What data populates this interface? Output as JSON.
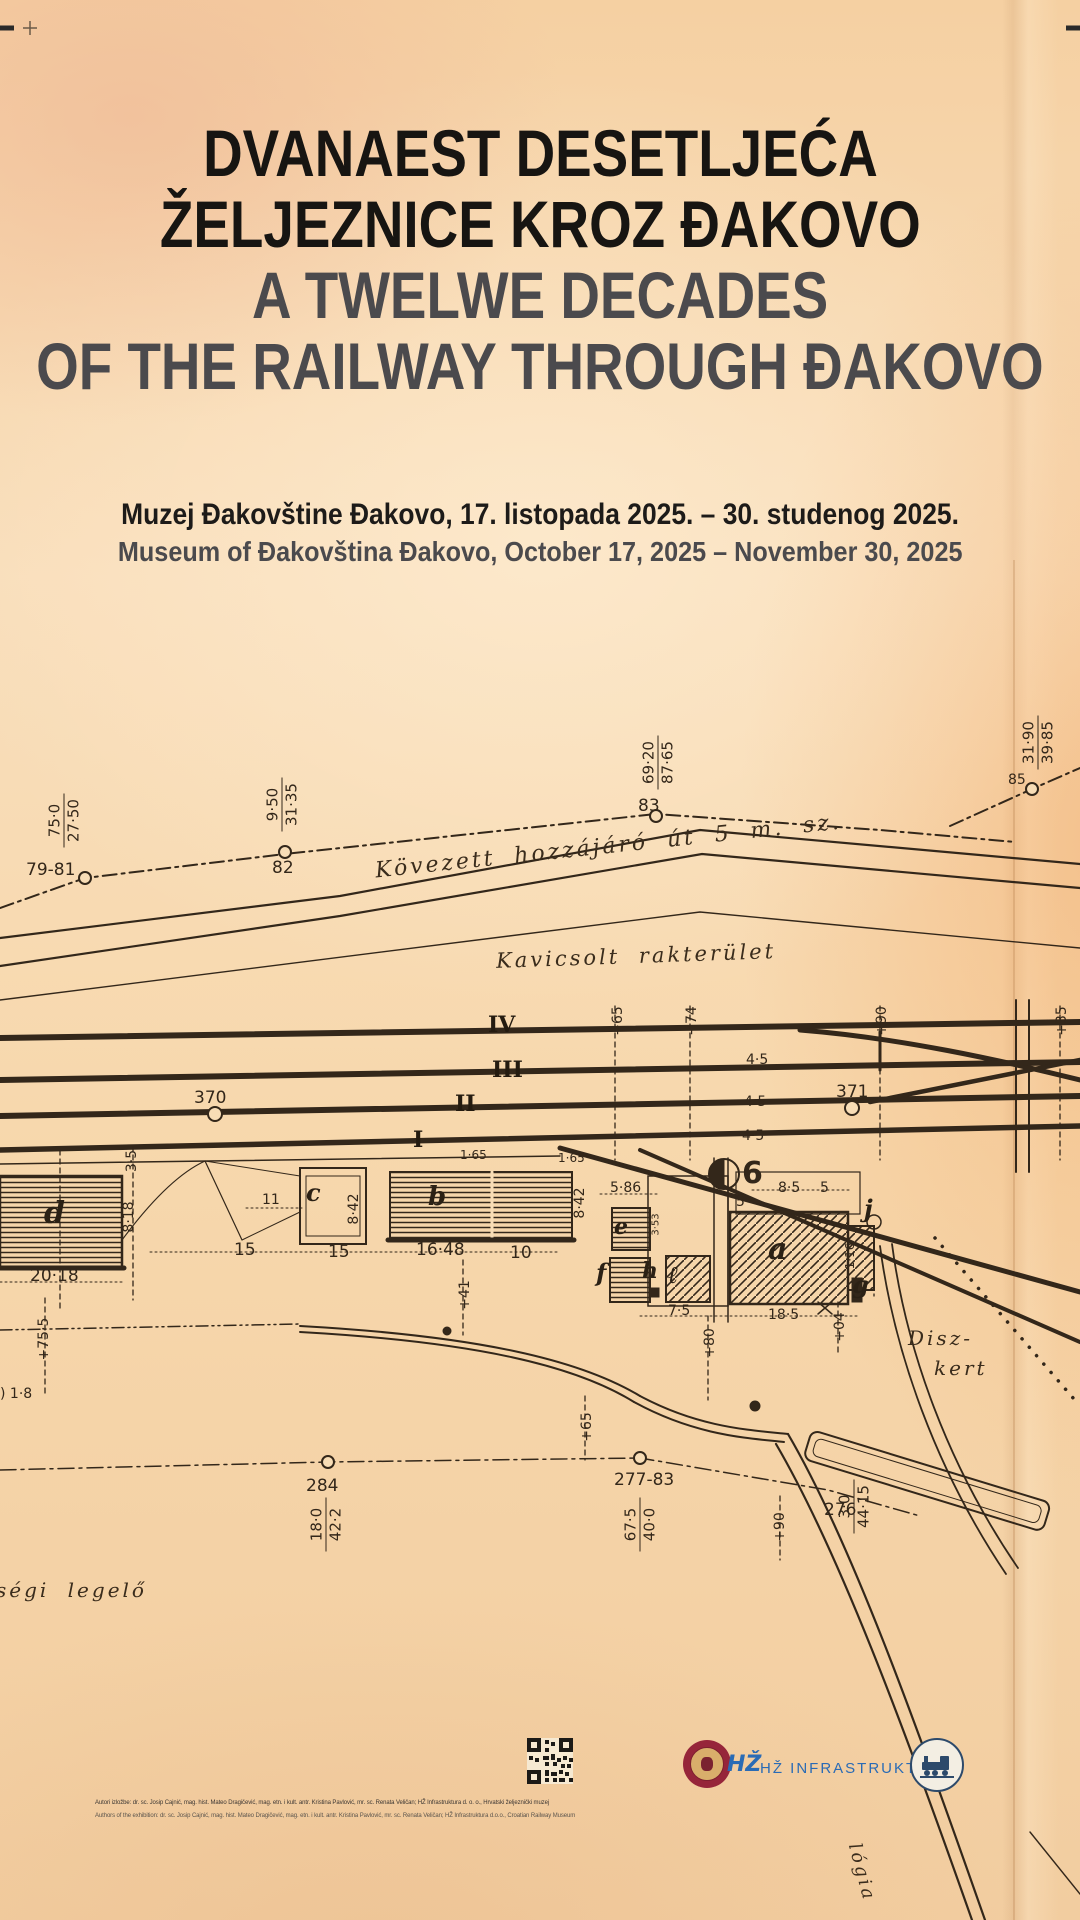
{
  "header": {
    "title_hr_1": "DVANAEST DESETLJEĆA",
    "title_hr_2": "ŽELJEZNICE KROZ ĐAKOVO",
    "title_en_1": "A TWELWE DECADES",
    "title_en_2": "OF THE RAILWAY THROUGH ĐAKOVO",
    "venue_hr": "Muzej Đakovštine Đakovo, 17. listopada 2025. – 30. studenog 2025.",
    "venue_en": "Museum of Đakovština Đakovo, October 17, 2025 – November 30, 2025"
  },
  "map": {
    "road_label": "Kövezett hozzájáró út 5 m. sz.",
    "area_label": "Kavicsolt rakterület",
    "diszkert": [
      "Disz-",
      "kert"
    ],
    "pasture_label": "ségi legelő",
    "bottom_edge_label": "lógia",
    "tracks": [
      "IV",
      "III",
      "II",
      "I"
    ],
    "gauges": [
      "4·5",
      "4·5",
      "4·5"
    ],
    "stations": {
      "s79": "79-81",
      "s82": "82",
      "s83": "83",
      "s85": "85",
      "s370": "370",
      "s371": "371",
      "s284": "284",
      "s277": "277-83",
      "s276": "276"
    },
    "fractions": [
      {
        "n": "75·0",
        "d": "27·50"
      },
      {
        "n": "9·50",
        "d": "31·35"
      },
      {
        "n": "69·20",
        "d": "87·65"
      },
      {
        "n": "31·90",
        "d": "39·85"
      },
      {
        "n": "18·0",
        "d": "42·2"
      },
      {
        "n": "67·5",
        "d": "40·0"
      },
      {
        "n": "3·0",
        "d": "44·15"
      }
    ],
    "offsets": [
      "+65",
      "+74",
      "+90",
      "+35",
      "+65",
      "+80",
      "+04",
      "+41",
      "+90",
      "+75·5",
      "1·16"
    ],
    "dims": {
      "d1": "3·5",
      "d2": "8·18",
      "d3": "20·18",
      "d4": "11",
      "d5": "15",
      "d6": "15",
      "d7": "16·48",
      "d8": "10",
      "d9": "1·65",
      "d10": "1·65",
      "d11": "8·42",
      "d12": "8·42",
      "d13": "5·86",
      "d14": "3·53",
      "d15": "7·5",
      "d16": "18·5",
      "d17": "8·5",
      "d18": "5",
      "d19": "5",
      "d20": ") 1·8"
    },
    "buildings": [
      "d",
      "c",
      "b",
      "e",
      "f",
      "h",
      "ℓ",
      "a",
      "j",
      "g"
    ],
    "turntable": "6"
  },
  "footer": {
    "credits_hr": "Autori izložbe: dr. sc. Josip Cajnić, mag. hist. Mateo Dragičević, mag. etn. i kult. antr. Kristina Pavlović, mr. sc. Renata Veličan; HŽ Infrastruktura d. o. o., Hrvatski željeznički muzej",
    "credits_en": "Authors of the exhibition: dr. sc. Josip Cajnić, mag. hist. Mateo Dragičević, mag. etn. i kult. antr. Kristina Pavlović, mr. sc. Renata Veličan; HŽ Infrastruktura d.o.o., Croatian Railway Museum",
    "hz_glyph": "HŽ",
    "hz_label": "HŽ INFRASTRUKTURA"
  }
}
